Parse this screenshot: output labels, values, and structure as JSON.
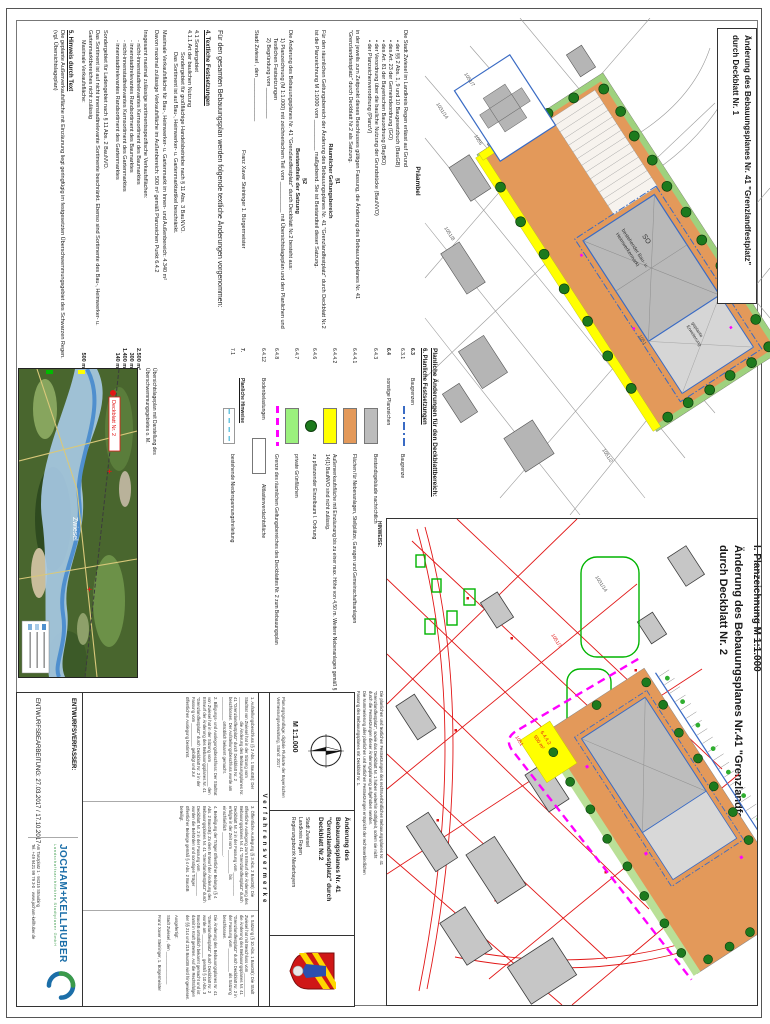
{
  "doc": {
    "sheet1_title_l1": "Änderung des Bebauungsplanes Nr. 41 \"Grenzlandfestplatz\"",
    "sheet1_title_l2": "durch Deckblatt Nr. 1",
    "sheet2_heading": "I. Planzeichnung M 1:1.000",
    "sheet2_title_l1": "Änderung des Bebauungsplanes Nr.41 \"Grenzlandfestplatz\"",
    "sheet2_title_l2": "durch Deckblatt Nr. 2"
  },
  "praeambel": {
    "heading": "Präambel",
    "intro": "Die Stadt Zwiesel im Landkreis Regen erlässt auf Grund",
    "bullets": [
      "•  der §§ 2 Abs. 1, 9 und 10 Baugesetzbuch (BauGB)",
      "•  des Art. 23 der Gemeindeordnung (GO)",
      "•  des Art. 81 der Bayerischen Bauordnung (BayBO)",
      "•  der Verordnung über die bauliche Nutzung der Grundstücke (BauNVO)",
      "•  der Planzeichenverordnung (PlanzV)"
    ],
    "closing": "in der jeweils zum Zeitpunkt dieses Beschlusses gültigen Fassung, die Änderung des Bebauungsplanes Nr. 41 \"Grenzlandfestplatz\" durch Deckblatt Nr.2 als Satzung."
  },
  "p1": {
    "num": "§1",
    "title": "Räumlicher Geltungsbereich",
    "body": "Für den räumlichen Geltungsbereich der Änderung des Bebauungsplanes Nr. 41 \"Grenzlandfestplatz\" durch Deckblatt Nr.2 ist die Planzeichnung M 1:1000 vom __________ maßgebend. Sie ist Bestandteil dieser Satzung."
  },
  "p2": {
    "num": "§2",
    "title": "Bestandteile der Satzung",
    "body": "Die Änderung des Bebauungsplanes Nr. 41 \"Grenzlandfestplatz\" durch Deckblatt Nr.2 besteht aus:",
    "item1": "1) Planzeichnung (M 1:1.000) mit zeichnerischem Teil vom __________ mit Übersichtslageplan und den Planlichen und Textlichen Festsetzungen",
    "item2": "2) Begründung vom __________"
  },
  "signature": {
    "city_line": "Stadt Zwiesel , den ______________",
    "name_line": "Franz Xaver Steininger 1. Bürgermeister"
  },
  "textliche": {
    "intro": "Für den gesamten Bebauungsplan werden folgende textliche Änderungen vorgenommen:",
    "h4": "4.   Textliche Festsetzungen",
    "s41": "4.1    Sondergebiet",
    "s411": "4.1.1  Art der baulichen Nutzung",
    "s411_a": "Sondergebiet für großflächige Handelsbetriebe nach § 11 Abs. 3 BauNVO.",
    "s411_b": "Das Sortiment ist auf Bau-, Heimwerker- u. Gartenmarktartikel beschränkt.",
    "max1": "Maximale Verkaufsfläche für Bau-, Heimwerker- u. Gartenmarkt im Innen- und Außenbereich: 4.340 m²",
    "max2": "Davon maximal zulässige Verkaufsfläche im Außenbereich: 500 m² gemäß Planzeichen Punkt 6.4.2",
    "sorti_head": "Insgesamt maximal zulässige sortimentsspezifische Verkaufsflächen:",
    "sorti": [
      {
        "label": "- nicht-innenstadtrelevantes Kernsortiment des Baumarktes",
        "value": "2.500 m²"
      },
      {
        "label": "- innenstadtrelevantes Randsortiment des Baumarktes",
        "value": "300 m²"
      },
      {
        "label": "- nicht-innenstadtrelevantes Kernsortiment des Gartenmarktes",
        "value": "1.400 m²"
      },
      {
        "label": "- innenstadtrelevantes Randsortiment des Gartenmarktes",
        "value": "140 m²"
      }
    ],
    "laden_a": "Sondergebiet für Ladengebiet nach § 11 Abs. 2 BauNVO.",
    "laden_b": "Das Sortiment ist auf nicht innenstadtrelevante Sortimente beschränkt. Ebenso sind Sortimente des Bau-, Heimwerker- u. Gartenmarktbereiches nicht zulässig",
    "laden_c": "Maximale Verkaufsfläche:",
    "laden_v": "500 m²",
    "h5": "5.   Hinweis durch Text",
    "h5_body": "Die geplante Außenverkaufsfläche mit Einzäunung liegt geringfügig im festgesetzten Überschwemmungsgebiet des Schwarzen Regen. (vgl. Übersichtslageplan)"
  },
  "legend": {
    "heading1": "Planliche Änderungen für den Deckblattbereich:",
    "heading2": "6.   Planliche Festsetzungen",
    "rows": [
      {
        "num": "6.3",
        "label": "Baugrenzen",
        "desc": ""
      },
      {
        "num": "6.3.1",
        "label": "",
        "desc": "Baugrenze"
      },
      {
        "num": "6.4",
        "label": "sonstige Planzeichen",
        "desc": ""
      },
      {
        "num": "6.4.3",
        "label": "",
        "desc": "Bestandsgebäude nachrichtlich"
      },
      {
        "num": "6.4.4.1",
        "label": "",
        "desc": "Flächen für Nebenanlagen, Stellplätze, Garagen und Gemeinschaftsanlagen"
      },
      {
        "num": "6.4.4.2",
        "label": "",
        "desc": "Außenverkaufsfläche mit Einzäunung bis zu einer max. Höhe von 4,50 m. Weitere Nebenanlagen gemäß § 14(1) BauNVO sind nicht zulässig."
      },
      {
        "num": "6.4.6",
        "label": "",
        "desc": "zu pflanzender Einzelbaum I. Ordnung"
      },
      {
        "num": "6.4.7",
        "label": "",
        "desc": "private Grünflächen"
      },
      {
        "num": "6.4.8",
        "label": "",
        "desc": "Grenze des räumlichen Geltungsbereiches des Deckblattes Nr. 2 zum Bebauungsplan"
      },
      {
        "num": "6.4.12",
        "label": "Bodenbelastungen",
        "desc": "Altlastenverdachtsfläche"
      },
      {
        "num": "7.",
        "label": "Planliche Hinweise",
        "desc": ""
      },
      {
        "num": "7.1",
        "label": "",
        "desc": "bestehende Niederspannungsfreileitung"
      }
    ]
  },
  "hinweise": {
    "heading": "HINWEISE:",
    "l1": "Die planlichen und textlichen Festsetzungen des rechtsverbindlichen Bebauungsplanes Nr. 41",
    "l2": "\"Grenzlandfestplatz\", sowie das Deckblatt Nr. 1 haben weiterhin Gültigkeit, sofern sie nicht",
    "l3": "durch die Festsetzungen dieser Änderungsplanung aufgehoben werden.",
    "l4": "Die Nummerierung aller planlichen und textlichen Festsetzungen entspricht der rechtsverbindlichen",
    "l5": "Fassung des Bebauungsplanes mit Deckblatt Nr. 1."
  },
  "uebersicht": {
    "caption1": "Übersichtslageplan mit Darstellung des",
    "caption2": "Überschwemmungsgebietes o. M.",
    "map_label": "Deckblatt Nr. 2",
    "city": "Zwiesel"
  },
  "titleblock": {
    "scale": "M  1:1.000",
    "datasource": "Planungsgrundlage: digitale Flurkarte der Bayerischen Vermessungsverwaltung, Stand: 2017",
    "head1": "Änderung des",
    "head2": "Bebauungsplanes Nr. 41",
    "head3": "\"Grenzlandfestplatz\" durch",
    "head4": "Deckblatt Nr.2",
    "region1": "Stadt Zwiesel",
    "region2": "Landkreis Regen",
    "region3": "Regierungsbezirk Niederbayern",
    "vermerke_header": "Verfahrensvermerke",
    "v1": "1. Aufstellungsbeschluss (§ 2 Abs. 1 BauGB): Der Stadtrat von Zwiesel hat in der Sitzung vom __________ die Änderung des Bebauungsplanes Nr. 41 \"Grenzlandfestplatz\" durch Deckblatt Nr. 2 beschlossen. Der Aufstellungsbeschluss wurde am __________ ortsüblich bekannt gemacht.",
    "v2": "2. Billigungs- und Auslegungsbeschluss: Der Stadtrat von Zwiesel hat in der Sitzung vom __________ den Entwurf der Änderung des Bebauungsplanes Nr. 41 \"Grenzlandfestplatz\" durch Deckblatt Nr. 2 in der Fassung vom __________ gebilligt und zur öffentlichen Auslegung bestimmt.",
    "v3": "3. Öffentliche Auslegung (§ 3 Abs. 2 BauGB): Die öffentliche Auslegung zum Entwurf der Änderung des Bebauungsplanes Nr. 41 \"Grenzlandfestplatz\" durch Deckblatt Nr. 2 in der Fassung vom __________ erfolgte in der Zeit vom __________ bis einschließlich __________.",
    "v4": "4. Beteiligung der Träger öffentlicher Belange (§ 4 Abs. 2 BauGB): Zu dem Entwurf der Änderung des Bebauungsplanes Nr. 41 \"Grenzlandfestplatz\" durch Deckblatt Nr. 2 in der Fassung vom __________ wurden die Behörden und sonstigen Träger öffentlicher Belange gemäß § 4 Abs. 2 BauGB beteiligt.",
    "v5": "5. Satzung (§ 10 Abs. 1 BauGB): Die Stadt Zwiesel hat mit Beschluss vom __________ die Änderung des Bebauungsplanes Nr. 41 \"Grenzlandfestplatz\" durch Deckblatt Nr. 2 in der Fassung vom __________ als Satzung beschlossen.",
    "v6": "Die Änderung des Bebauungsplanes Nr. 41 \"Grenzlandfestplatz\" durch Deckblatt Nr. 2 wurde am __________ gemäß § 10 Abs. 3 BauGB ortsüblich bekannt gemacht und ist damit in Kraft getreten. Auf die Rechtsfolgen der §§ 214 und 215 BauGB wird hingewiesen.",
    "ausgefertigt": "Ausgefertigt:",
    "sig_city": "Stadt Zwiesel , den ______________",
    "sig_name": "Franz Xaver Steininger, 1. Bürgermeister",
    "entwurf1": "ENTWURFSVERFASSER:",
    "entwurf2": "ENTWURFSBEARBEITUNG: 27.03.2017 / 17.10.2017"
  },
  "logo": {
    "name": "JOCHAM+KELLHUBER",
    "subtitle": "Landschaftsarchitekten Stadtplaner GmbH",
    "addr1": "Am Tanzplatz 1 · 94315 Straubing",
    "addr2": "Tel. +49 9421 99 79 3-0 · www.jocham-kellhuber.de"
  },
  "plan1": {
    "label_so": "SO",
    "label_bld1a": "bestehender Bau- u.",
    "label_bld1b": "Heimwerkermarkt",
    "label_bld2a": "geplante",
    "label_bld2b": "Erweiterung",
    "parcels": [
      "1055",
      "1051",
      "1051/7",
      "1051/2",
      "1031/14",
      "1051/8"
    ]
  },
  "plan2": {
    "label_yellow": "6.4.4.2",
    "label_yellow2": "500 m²",
    "parcels": [
      "1051",
      "1051/7",
      "1031/14"
    ]
  },
  "colors": {
    "orange_area": "#e3995a",
    "yellow_area": "#ffff00",
    "tree_green": "#1d7a1d",
    "green_area": "#9bf07d",
    "magenta_boundary": "#ff00ff",
    "red_parcel": "#e11616",
    "blue_baugrenze": "#3a6bc4",
    "logo_blue": "#1b6ea8",
    "logo_green": "#3a9a4a"
  }
}
